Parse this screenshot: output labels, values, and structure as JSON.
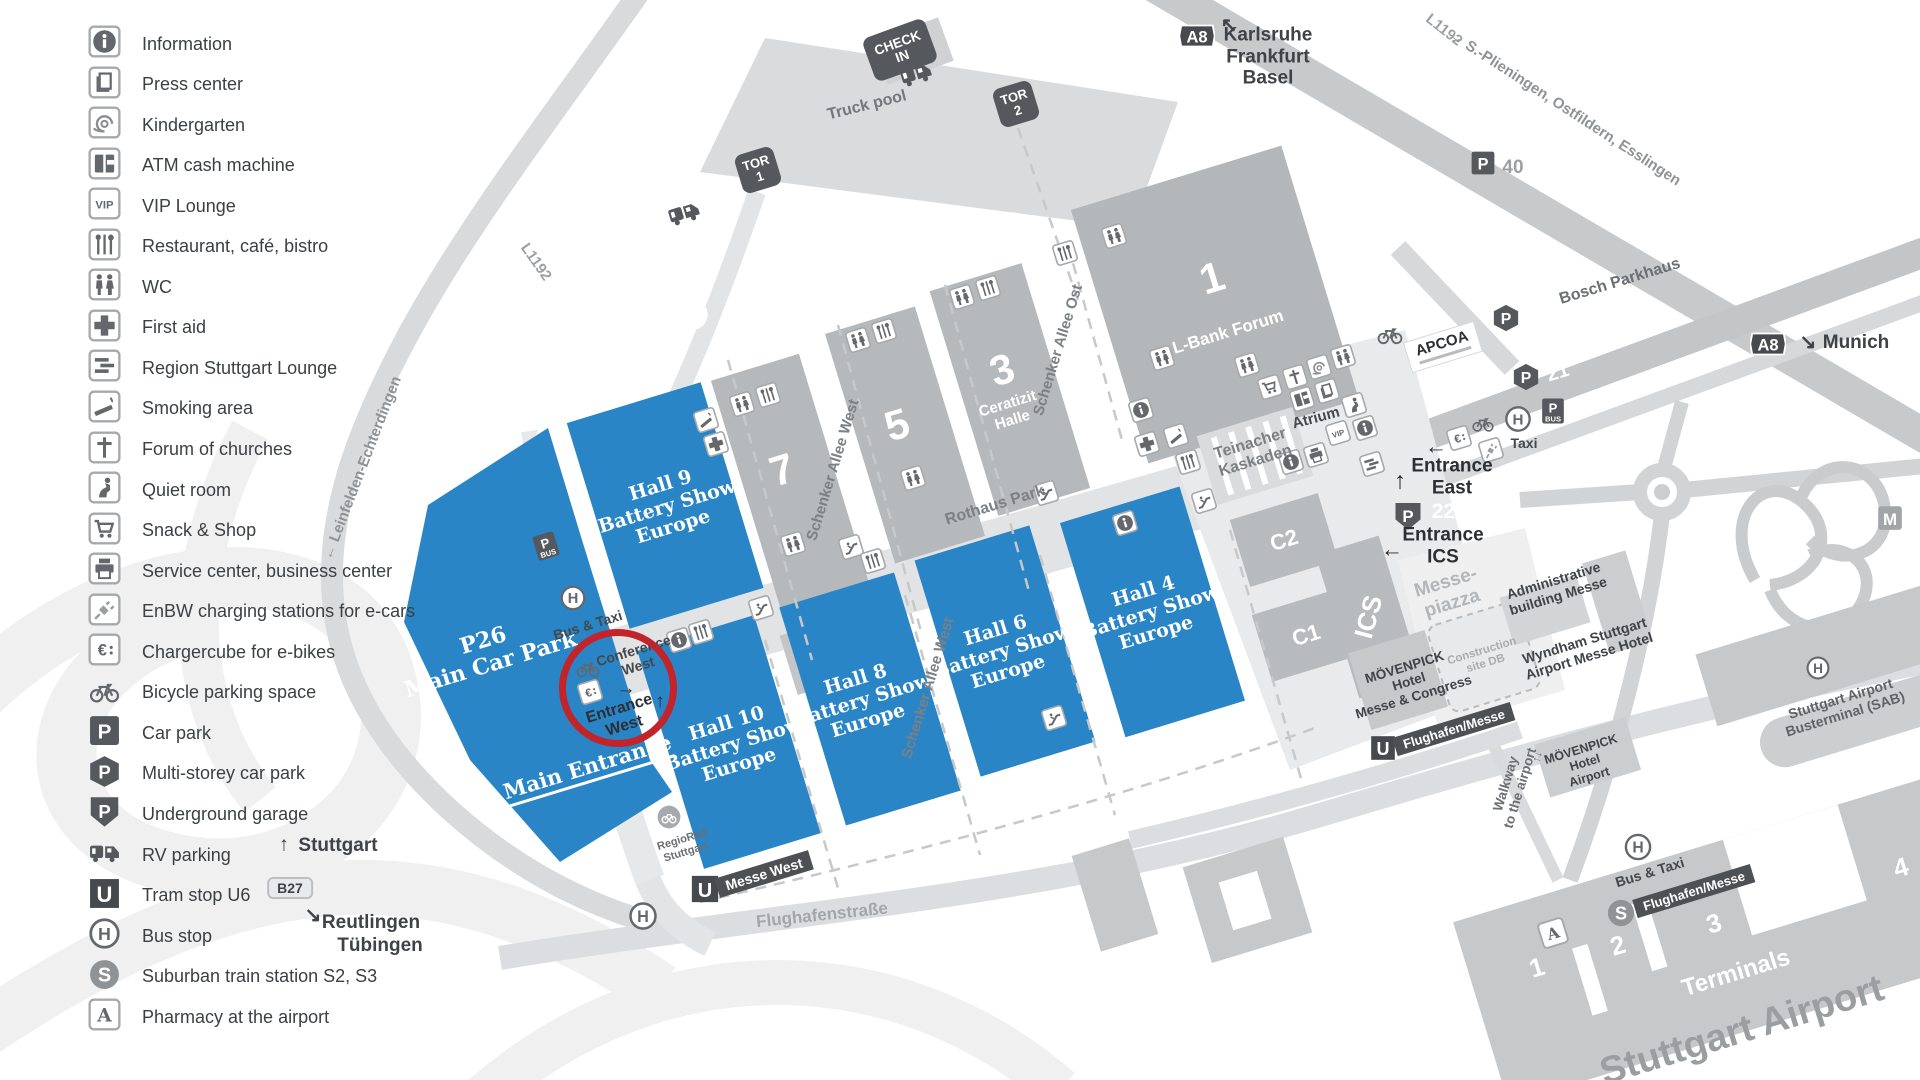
{
  "colors": {
    "hall_blue": "#2a85c6",
    "circle_red": "#c2242a",
    "badge_dark": "#55585c",
    "text_dark": "#3f4347"
  },
  "legend": {
    "items": [
      {
        "icon": "info",
        "label": "Information"
      },
      {
        "icon": "press",
        "label": "Press center"
      },
      {
        "icon": "kindergarten",
        "label": "Kindergarten"
      },
      {
        "icon": "atm",
        "label": "ATM cash machine"
      },
      {
        "icon": "vip",
        "label": "VIP Lounge"
      },
      {
        "icon": "restaurant",
        "label": "Restaurant, café, bistro"
      },
      {
        "icon": "wc",
        "label": "WC"
      },
      {
        "icon": "first-aid",
        "label": "First aid"
      },
      {
        "icon": "lounge",
        "label": "Region Stuttgart Lounge"
      },
      {
        "icon": "smoking",
        "label": "Smoking area"
      },
      {
        "icon": "church",
        "label": "Forum of churches"
      },
      {
        "icon": "quiet",
        "label": "Quiet room"
      },
      {
        "icon": "cart",
        "label": "Snack & Shop"
      },
      {
        "icon": "printer",
        "label": "Service center, business center"
      },
      {
        "icon": "enbw",
        "label": "EnBW charging stations for e-cars"
      },
      {
        "icon": "charge",
        "label": "Chargercube for e-bikes"
      },
      {
        "icon": "bike",
        "label": "Bicycle parking space"
      },
      {
        "icon": "p-square",
        "label": "Car park"
      },
      {
        "icon": "p-multi",
        "label": "Multi-storey car park"
      },
      {
        "icon": "p-under",
        "label": "Underground garage"
      },
      {
        "icon": "rv",
        "label": "RV parking"
      },
      {
        "icon": "u",
        "label": "Tram stop U6"
      },
      {
        "icon": "h",
        "label": "Bus stop"
      },
      {
        "icon": "s",
        "label": "Suburban train station S2, S3"
      },
      {
        "icon": "pharmacy",
        "label": "Pharmacy at the airport"
      }
    ]
  },
  "directions": {
    "arrow_up": "↑",
    "stuttgart": "Stuttgart",
    "b27": "B27",
    "arrow_se": "↘",
    "reutlingen": "Reutlingen",
    "tuebingen": "Tübingen"
  },
  "map": {
    "check_in": {
      "l1": "CHECK",
      "l2": "IN"
    },
    "truck_pool": "Truck pool",
    "tor": {
      "word": "TOR",
      "n1": "1",
      "n2": "2"
    },
    "nw": {
      "arrow": "↖",
      "l1": "Karlsruhe",
      "l2": "Frankfurt",
      "l3": "Basel"
    },
    "munich": {
      "arrow": "↘",
      "label": "Munich"
    },
    "l1192": "L1192",
    "plieningen": "→ S.-Plieningen, Ostfildern, Esslingen",
    "leinfelden": "← Leinfelden-Echterdingen",
    "p40": "40",
    "p20": "20",
    "p21": "21",
    "p2223": "22/23",
    "bosch": "Bosch Parkhaus",
    "apcoa": "APCOA",
    "gray_halls": {
      "h7": "7",
      "h5": "5",
      "h3": "3",
      "ceratizit": {
        "l1": "Ceratizit",
        "l2": "Halle"
      },
      "h1": "1",
      "lbank": "L-Bank Forum"
    },
    "blue_halls": [
      {
        "l1": "Hall 9",
        "l2": "Battery Show",
        "l3": "Europe"
      },
      {
        "l1": "Hall 10",
        "l2": "Battery Show",
        "l3": "Europe"
      },
      {
        "l1": "Hall 8",
        "l2": "Battery Show",
        "l3": "Europe"
      },
      {
        "l1": "Hall 6",
        "l2": "Battery Show",
        "l3": "Europe"
      },
      {
        "l1": "Hall 4",
        "l2": "Battery Show",
        "l3": "Europe"
      }
    ],
    "p26": {
      "l1": "P26",
      "l2": "Main Car Park"
    },
    "main_entrance": "Main Entrance",
    "conference": {
      "l1": "Conference",
      "l2": "West"
    },
    "entrance_west": {
      "arrow1": "→",
      "arrow2": "↑",
      "l1": "Entrance",
      "l2": "West"
    },
    "entrance_east": {
      "arrow": "↑",
      "l1": "Entrance",
      "l2": "East"
    },
    "entrance_ics": {
      "arrow": "←",
      "l1": "Entrance",
      "l2": "ICS"
    },
    "charge_arrow": "←",
    "messepiazza": {
      "l1": "Messe-",
      "l2": "piazza"
    },
    "ics": "ICS",
    "c1": "C1",
    "c2": "C2",
    "construction": {
      "l1": "Construction",
      "l2": "site DB"
    },
    "atrium": "Atrium",
    "teinacher": {
      "l1": "Teinacher",
      "l2": "Kaskaden"
    },
    "rothaus": "Rothaus Park",
    "schenker_west": "Schenker Allee West",
    "schenker_ost": "Schenker Allee Ost",
    "bus_taxi": "Bus & Taxi",
    "taxi": "Taxi",
    "regiorad": {
      "l1": "RegioRad",
      "l2": "Stuttgart"
    },
    "messe_west": "Messe West",
    "flughafenstrasse": "Flughafenstraße",
    "flughafen_messe": "Flughafen/Messe",
    "admin": {
      "l1": "Administrative",
      "l2": "building Messe"
    },
    "moevenpick_mc": {
      "brand": "MÖVENPICK",
      "l1": "Hotel",
      "l2": "Messe & Congress"
    },
    "moevenpick_ap": {
      "brand": "MÖVENPICK",
      "l1": "Hotel",
      "l2": "Airport"
    },
    "wyndham": {
      "l1": "Wyndham Stuttgart",
      "l2": "Airport Messe Hotel"
    },
    "walkway": {
      "l1": "Walkway",
      "l2": "to the airport",
      "arrows": "↑↓"
    },
    "sab": {
      "l1": "Stuttgart Airport",
      "l2": "Busterminal (SAB)"
    },
    "terminals": "Terminals",
    "t1": "1",
    "t2": "2",
    "t3": "3",
    "t4": "4",
    "stuttgart_airport": "Stuttgart Airport",
    "icons": [
      {
        "s": "rv",
        "x": 916,
        "y": 74,
        "w": 34
      },
      {
        "s": "rv",
        "x": 684,
        "y": 213,
        "w": 34
      },
      {
        "s": "smoking",
        "x": 706,
        "y": 420
      },
      {
        "s": "wc",
        "x": 742,
        "y": 404
      },
      {
        "s": "restaurant",
        "x": 768,
        "y": 395
      },
      {
        "s": "first-aid",
        "x": 716,
        "y": 444
      },
      {
        "s": "wc",
        "x": 858,
        "y": 340
      },
      {
        "s": "restaurant",
        "x": 884,
        "y": 331
      },
      {
        "s": "wc",
        "x": 913,
        "y": 478
      },
      {
        "s": "wc",
        "x": 962,
        "y": 297
      },
      {
        "s": "restaurant",
        "x": 988,
        "y": 288
      },
      {
        "s": "restaurant",
        "x": 1065,
        "y": 253
      },
      {
        "s": "wc",
        "x": 1114,
        "y": 236
      },
      {
        "s": "wc",
        "x": 1162,
        "y": 358
      },
      {
        "s": "wc",
        "x": 793,
        "y": 544
      },
      {
        "s": "escalator",
        "x": 851,
        "y": 547
      },
      {
        "s": "restaurant",
        "x": 873,
        "y": 561
      },
      {
        "s": "escalator",
        "x": 1046,
        "y": 493
      },
      {
        "s": "escalator",
        "x": 761,
        "y": 608
      },
      {
        "s": "info",
        "x": 679,
        "y": 640
      },
      {
        "s": "restaurant",
        "x": 701,
        "y": 632
      },
      {
        "s": "escalator",
        "x": 1054,
        "y": 718
      },
      {
        "s": "escalator",
        "x": 1204,
        "y": 501
      },
      {
        "s": "info",
        "x": 1125,
        "y": 523
      },
      {
        "s": "info",
        "x": 1141,
        "y": 410
      },
      {
        "s": "first-aid",
        "x": 1147,
        "y": 444
      },
      {
        "s": "smoking",
        "x": 1176,
        "y": 436
      },
      {
        "s": "restaurant",
        "x": 1188,
        "y": 462
      },
      {
        "s": "wc",
        "x": 1247,
        "y": 365
      },
      {
        "s": "cart",
        "x": 1270,
        "y": 387
      },
      {
        "s": "church",
        "x": 1295,
        "y": 377
      },
      {
        "s": "kindergarten",
        "x": 1319,
        "y": 367
      },
      {
        "s": "wc",
        "x": 1343,
        "y": 357
      },
      {
        "s": "atm",
        "x": 1302,
        "y": 399
      },
      {
        "s": "press",
        "x": 1327,
        "y": 391
      },
      {
        "s": "quiet",
        "x": 1354,
        "y": 405
      },
      {
        "s": "vip",
        "x": 1338,
        "y": 433
      },
      {
        "s": "info",
        "x": 1365,
        "y": 428
      },
      {
        "s": "info",
        "x": 1291,
        "y": 462
      },
      {
        "s": "printer",
        "x": 1316,
        "y": 455
      },
      {
        "s": "lounge",
        "x": 1372,
        "y": 464
      },
      {
        "s": "bike",
        "x": 1390,
        "y": 334,
        "w": 28,
        "r": 0
      },
      {
        "s": "charge",
        "x": 1459,
        "y": 438
      },
      {
        "s": "bike",
        "x": 1483,
        "y": 423,
        "w": 24,
        "r": 0
      },
      {
        "s": "enbw",
        "x": 1491,
        "y": 450
      },
      {
        "s": "h",
        "x": 1518,
        "y": 419,
        "w": 28,
        "r": 0
      },
      {
        "s": "pbus",
        "x": 1553,
        "y": 411,
        "w": 26,
        "r": 0
      },
      {
        "s": "pbus",
        "x": 546,
        "y": 546,
        "w": 26
      },
      {
        "s": "h",
        "x": 573,
        "y": 598,
        "w": 27,
        "r": 0
      },
      {
        "s": "bike",
        "x": 588,
        "y": 668,
        "w": 26,
        "r": 0
      },
      {
        "s": "charge",
        "x": 590,
        "y": 692
      },
      {
        "s": "p-square",
        "x": 1483,
        "y": 163,
        "w": 26,
        "r": 0
      },
      {
        "s": "p-multi",
        "x": 1506,
        "y": 318,
        "w": 28,
        "r": 0
      },
      {
        "s": "p-multi",
        "x": 1526,
        "y": 377,
        "w": 28,
        "r": 0
      },
      {
        "s": "p-under",
        "x": 1408,
        "y": 516,
        "w": 30,
        "r": 0
      },
      {
        "s": "h",
        "x": 1638,
        "y": 847,
        "w": 29,
        "r": 0
      },
      {
        "s": "h",
        "x": 1818,
        "y": 668,
        "w": 25,
        "r": 0
      },
      {
        "s": "h",
        "x": 643,
        "y": 916,
        "w": 30,
        "r": 0
      },
      {
        "s": "u",
        "x": 705,
        "y": 889,
        "w": 30,
        "r": 0
      },
      {
        "s": "u",
        "x": 1383,
        "y": 748,
        "w": 27,
        "r": 0
      },
      {
        "s": "s",
        "x": 1621,
        "y": 913,
        "w": 30,
        "r": 0
      },
      {
        "s": "pharmacy",
        "x": 1553,
        "y": 933,
        "w": 28
      },
      {
        "s": "regiorad",
        "x": 669,
        "y": 817,
        "w": 26,
        "r": 0
      },
      {
        "s": "m",
        "x": 1890,
        "y": 518,
        "w": 27,
        "r": 0
      },
      {
        "s": "a8",
        "x": 1197,
        "y": 36,
        "w": 36,
        "r": 0
      },
      {
        "s": "a8",
        "x": 1768,
        "y": 344,
        "w": 36,
        "r": 0
      }
    ]
  }
}
